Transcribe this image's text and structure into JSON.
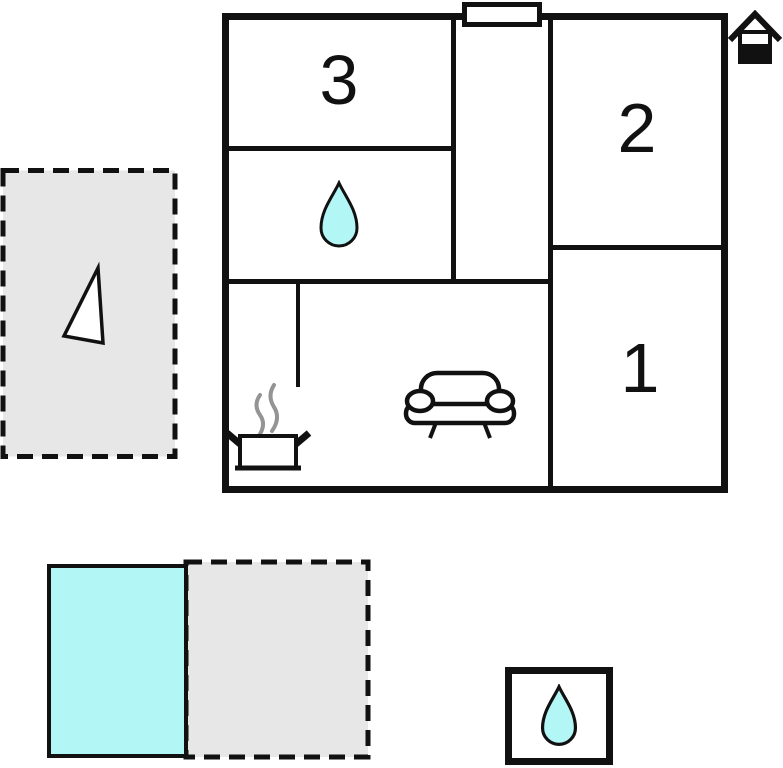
{
  "floor_plan": {
    "title": "apartment-floor-plan",
    "rooms": [
      {
        "id": "room-3",
        "label": "3"
      },
      {
        "id": "room-2",
        "label": "2"
      },
      {
        "id": "room-1",
        "label": "1"
      }
    ],
    "icons": {
      "bathroom_water_drop": "water-drop-icon",
      "detached_water_drop": "water-drop-icon",
      "kitchen_pot": "cooking-pot-steam-icon",
      "living_room_sofa": "sofa-icon",
      "house_marker": "house-icon",
      "terrace_arrow": "triangle-arrow-icon",
      "entrance": "door-opening"
    },
    "areas": {
      "terrace_left": "dashed-terrace-area",
      "pool": "swimming-pool",
      "patio_bottom": "dashed-patio-area",
      "water_feature_square": "water-drop-square"
    },
    "colors": {
      "wall": "#111111",
      "water": "#b3f6f6",
      "area_fill": "#e7e7e7",
      "steam": "#949494",
      "background": "#ffffff"
    }
  }
}
